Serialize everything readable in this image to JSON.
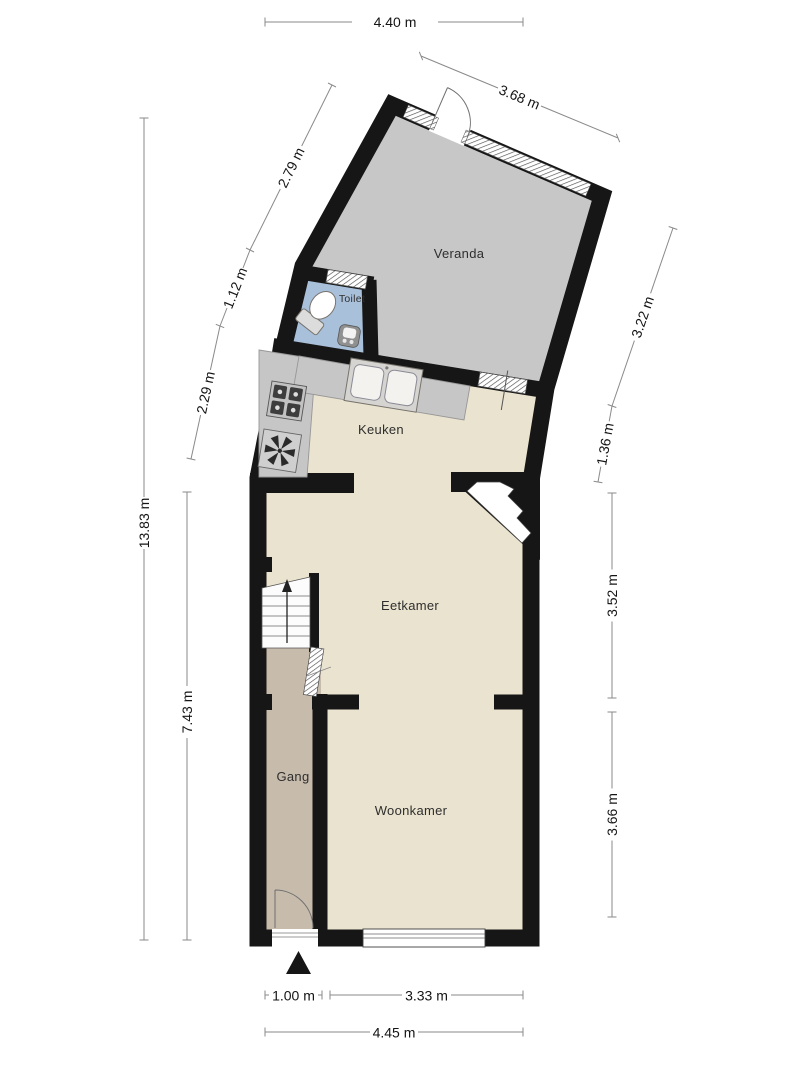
{
  "rooms": {
    "veranda": "Veranda",
    "toilet": "Toilet",
    "keuken": "Keuken",
    "eetkamer": "Eetkamer",
    "gang": "Gang",
    "woonkamer": "Woonkamer"
  },
  "dimensions": {
    "top_width": "4.40 m",
    "veranda_top_wall": "3.68 m",
    "veranda_left_wall": "2.79 m",
    "toilet_left_wall": "1.12 m",
    "keuken_left_wall": "2.29 m",
    "total_height_left": "13.83 m",
    "lower_height_left": "7.43 m",
    "veranda_right_wall": "3.22 m",
    "keuken_right_wall": "1.36 m",
    "eetkamer_right_height": "3.52 m",
    "woonkamer_right_height": "3.66 m",
    "entrance_width": "1.00 m",
    "woonkamer_width": "3.33 m",
    "total_width_bottom": "4.45 m"
  },
  "icons": {
    "entrance_marker": "north-arrow-triangle",
    "toilet_fixture": "toilet-icon",
    "hand_basin": "sink-icon",
    "kitchen_sink": "double-sink-icon",
    "hob": "stove-icon",
    "ventilation": "fan-icon",
    "stairs": "stairs-up-icon"
  },
  "colors": {
    "wall": "#161616",
    "floor_veranda": "#c7c7c7",
    "floor_toilet": "#a9c0da",
    "floor_living": "#eae3cf",
    "floor_gang": "#c7bbac",
    "counter": "#c6c6c6",
    "dim_line": "#8a8a8a",
    "dim_text": "#141414",
    "room_label": "#2e2e2e",
    "background": "#ffffff"
  }
}
